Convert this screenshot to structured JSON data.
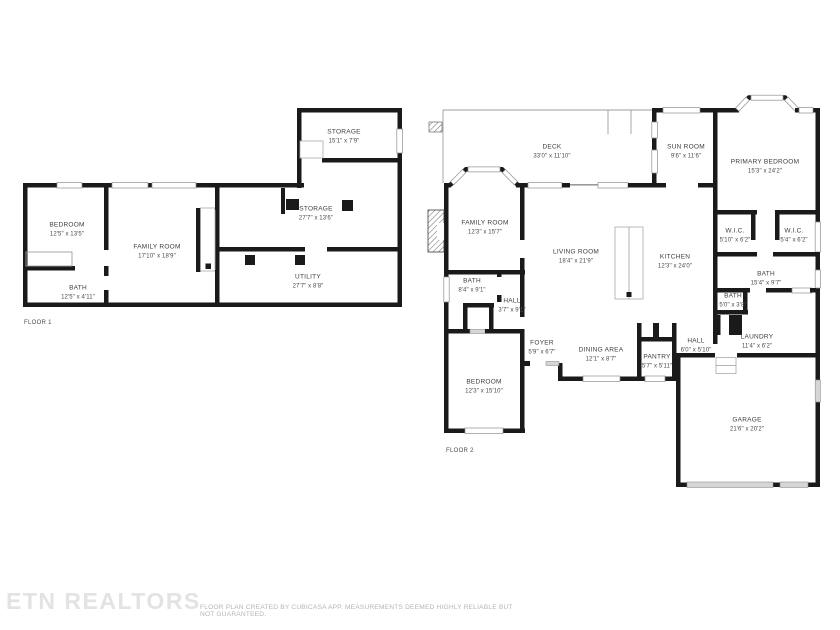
{
  "watermark": "ETN REALTORS",
  "disclaimer": "FLOOR PLAN CREATED BY CUBICASA APP. MEASUREMENTS DEEMED HIGHLY RELIABLE BUT NOT GUARANTEED.",
  "colors": {
    "wall": "#1a1a1a",
    "window_stroke": "#8f8f8f",
    "door_fill": "#d6d6d6",
    "label_text": "#3d3d3d",
    "watermark": "#e3e3e3",
    "disclaimer": "#b5b5b5"
  },
  "floor1": {
    "label": "FLOOR 1",
    "rooms": [
      {
        "name": "STORAGE",
        "dims": "15'1\" x 7'9\""
      },
      {
        "name": "STORAGE",
        "dims": "27'7\" x 13'6\""
      },
      {
        "name": "BEDROOM",
        "dims": "12'5\" x 13'5\""
      },
      {
        "name": "FAMILY ROOM",
        "dims": "17'10\" x 18'9\""
      },
      {
        "name": "BATH",
        "dims": "12'5\" x 4'11\""
      },
      {
        "name": "UTILITY",
        "dims": "27'7\" x 8'8\""
      }
    ]
  },
  "floor2": {
    "label": "FLOOR 2",
    "rooms": [
      {
        "name": "DECK",
        "dims": "33'0\" x 11'10\""
      },
      {
        "name": "SUN ROOM",
        "dims": "9'6\" x 11'6\""
      },
      {
        "name": "PRIMARY BEDROOM",
        "dims": "15'3\" x 24'2\""
      },
      {
        "name": "FAMILY ROOM",
        "dims": "12'3\" x 15'7\""
      },
      {
        "name": "LIVING ROOM",
        "dims": "18'4\" x 21'9\""
      },
      {
        "name": "KITCHEN",
        "dims": "12'3\" x 24'0\""
      },
      {
        "name": "W.I.C.",
        "dims": "5'10\" x 6'2\""
      },
      {
        "name": "W.I.C.",
        "dims": "5'4\" x 6'2\""
      },
      {
        "name": "BATH",
        "dims": "15'4\" x 9'7\""
      },
      {
        "name": "BATH",
        "dims": "8'4\" x 9'1\""
      },
      {
        "name": "HALL",
        "dims": "3'7\" x 9'1\""
      },
      {
        "name": "BATH",
        "dims": "5'0\" x 3'8\""
      },
      {
        "name": "LAUNDRY",
        "dims": "11'4\" x 6'2\""
      },
      {
        "name": "FOYER",
        "dims": "5'9\" x 6'7\""
      },
      {
        "name": "DINING AREA",
        "dims": "12'1\" x 8'7\""
      },
      {
        "name": "PANTRY",
        "dims": "5'7\" x 5'11\""
      },
      {
        "name": "HALL",
        "dims": "6'0\" x 5'10\""
      },
      {
        "name": "BEDROOM",
        "dims": "12'3\" x 15'10\""
      },
      {
        "name": "GARAGE",
        "dims": "21'6\" x 20'2\""
      }
    ]
  }
}
